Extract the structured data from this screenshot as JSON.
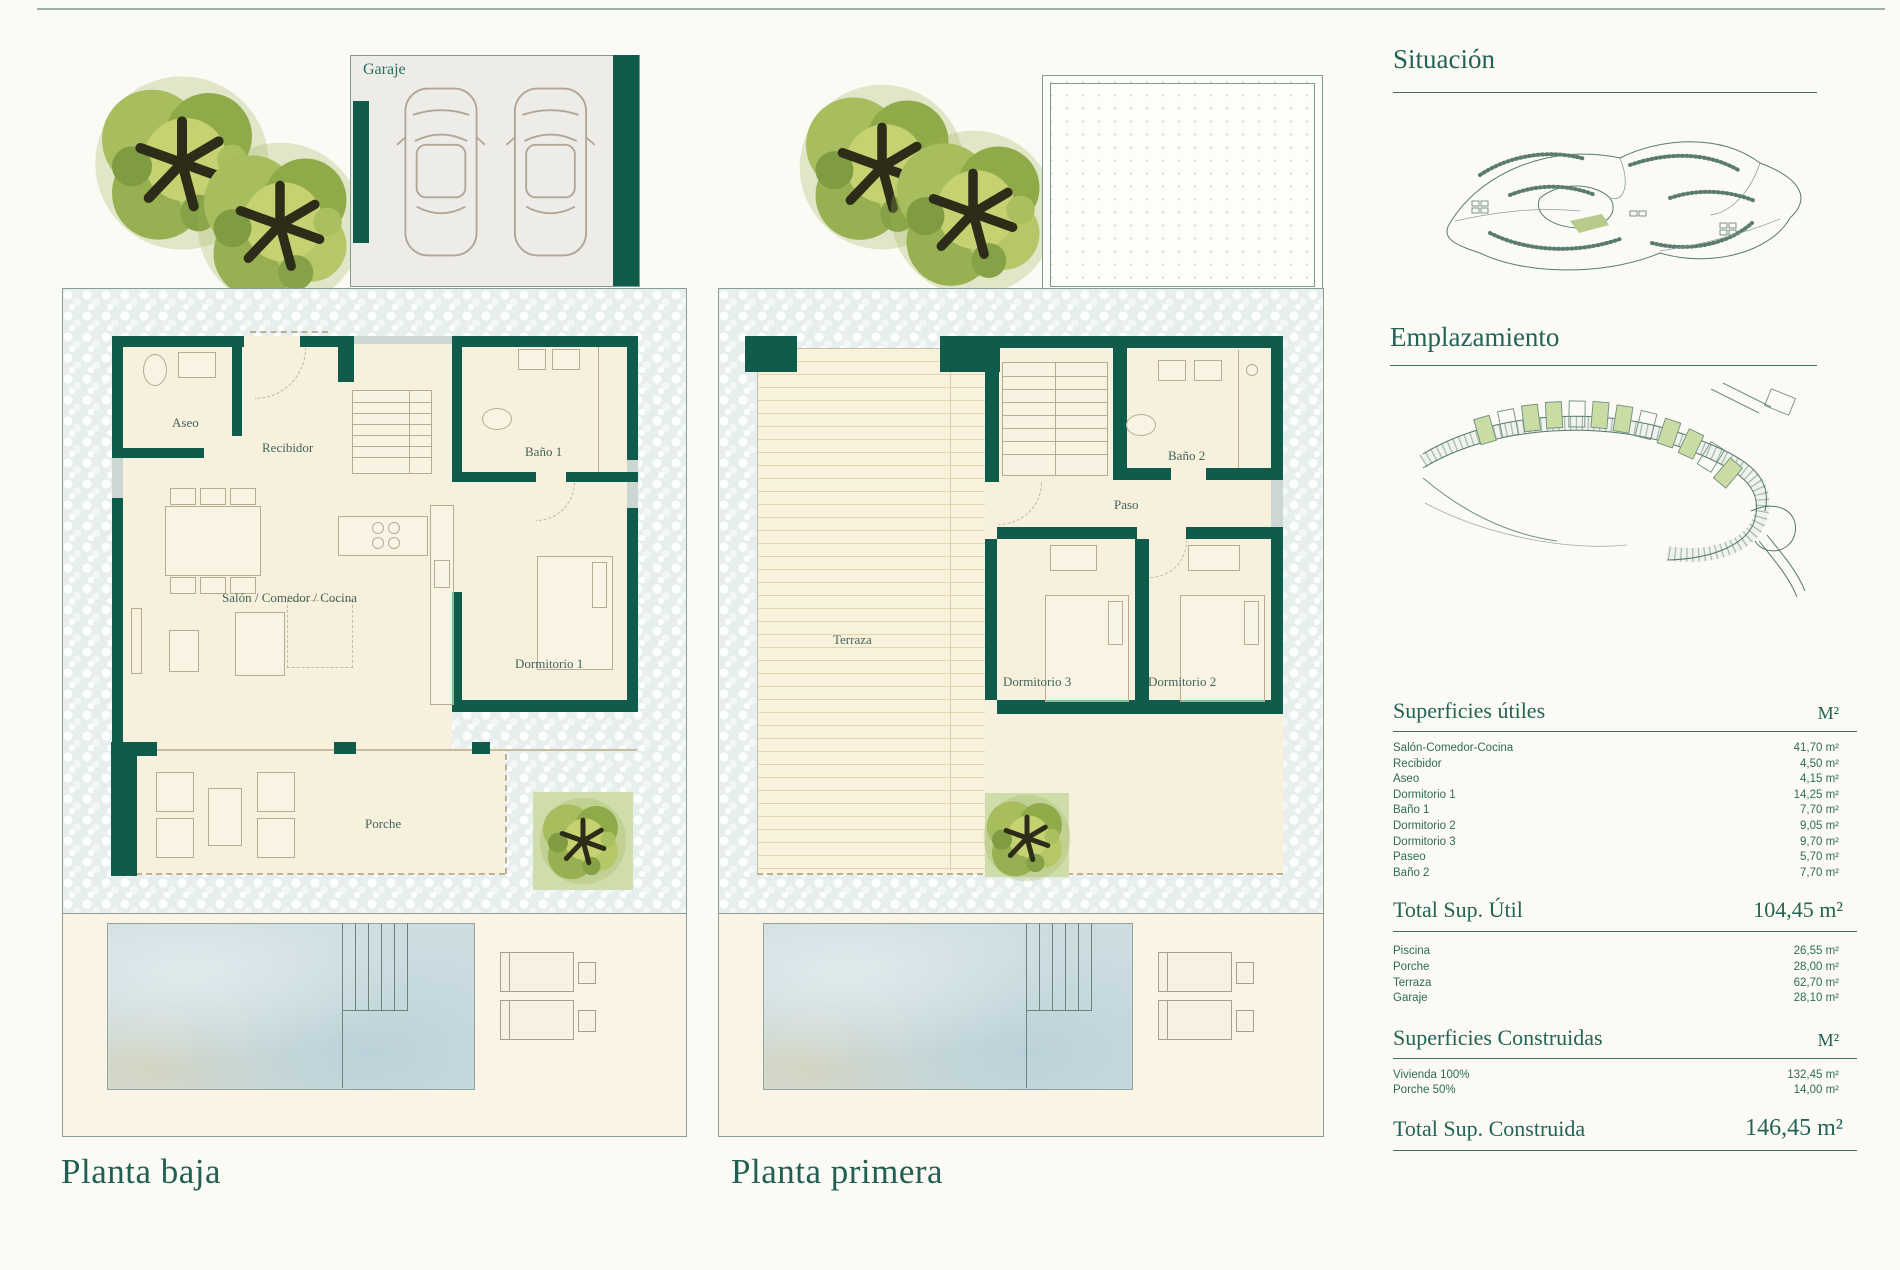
{
  "colors": {
    "wall_teal": "#0f5c4d",
    "heading": "#216456",
    "table_text": "#2e6b58",
    "plot_green": "#cfddab"
  },
  "planta_baja": {
    "title": "Planta baja",
    "rooms": {
      "garaje": "Garaje",
      "aseo": "Aseo",
      "recibidor": "Recibidor",
      "bano1": "Baño 1",
      "salon": "Salón / Comedor / Cocina",
      "dormitorio1": "Dormitorio 1",
      "porche": "Porche"
    }
  },
  "planta_primera": {
    "title": "Planta primera",
    "rooms": {
      "terraza": "Terraza",
      "bano2": "Baño 2",
      "paso": "Paso",
      "dormitorio3": "Dormitorio 3",
      "dormitorio2": "Dormitorio 2"
    }
  },
  "sidebar": {
    "situacion_title": "Situación",
    "emplazamiento_title": "Emplazamiento",
    "superficies_utiles": {
      "title": "Superficies útiles",
      "unit": "M²",
      "rows": [
        {
          "label": "Salón-Comedor-Cocina",
          "value": "41,70 m²"
        },
        {
          "label": "Recibidor",
          "value": "4,50 m²"
        },
        {
          "label": "Aseo",
          "value": "4,15 m²"
        },
        {
          "label": "Dormitorio 1",
          "value": "14,25 m²"
        },
        {
          "label": "Baño 1",
          "value": "7,70 m²"
        },
        {
          "label": "Dormitorio 2",
          "value": "9,05 m²"
        },
        {
          "label": "Dormitorio 3",
          "value": "9,70 m²"
        },
        {
          "label": "Paseo",
          "value": "5,70 m²"
        },
        {
          "label": "Baño 2",
          "value": "7,70 m²"
        }
      ],
      "total": {
        "label": "Total Sup. Útil",
        "value": "104,45 m²"
      },
      "extra_rows": [
        {
          "label": "Piscina",
          "value": "26,55 m²"
        },
        {
          "label": "Porche",
          "value": "28,00 m²"
        },
        {
          "label": "Terraza",
          "value": "62,70 m²"
        },
        {
          "label": "Garaje",
          "value": "28,10 m²"
        }
      ]
    },
    "superficies_construidas": {
      "title": "Superficies Construidas",
      "unit": "M²",
      "rows": [
        {
          "label": "Vivienda 100%",
          "value": "132,45 m²"
        },
        {
          "label": "Porche 50%",
          "value": "14,00 m²"
        }
      ],
      "total": {
        "label": "Total Sup. Construida",
        "value": "146,45 m²"
      }
    }
  }
}
